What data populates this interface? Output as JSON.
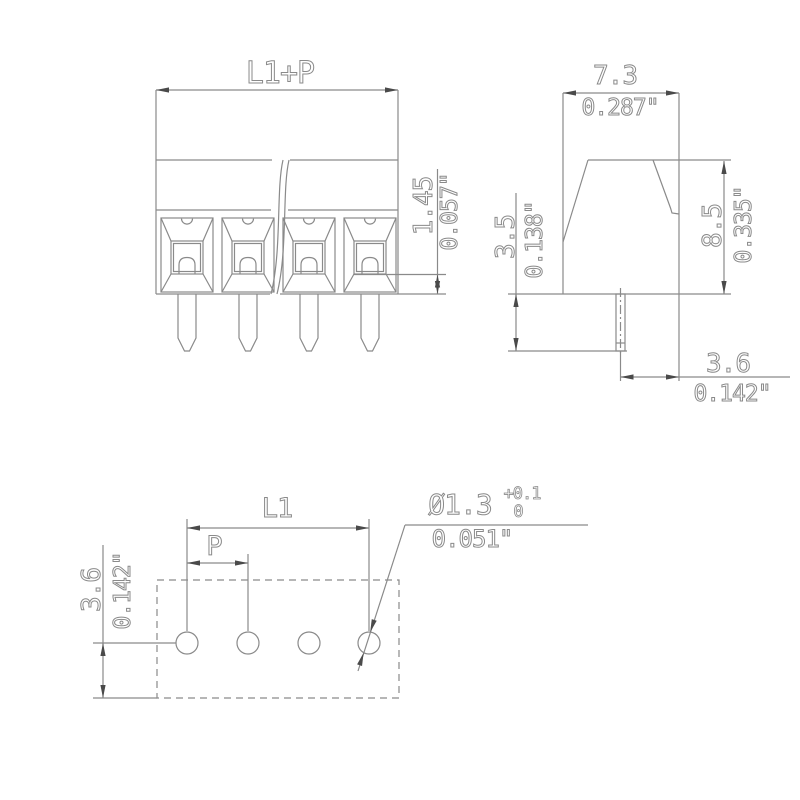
{
  "drawing_type": "terminal-block-dimension-drawing",
  "views": {
    "front": {
      "width_label": "L1+P",
      "depth_mm": "1.45",
      "depth_in": "0.057\"",
      "pole_count_visible": 4
    },
    "side": {
      "width_mm": "7.3",
      "width_in": "0.287\"",
      "pin_len_mm": "3.5",
      "pin_len_in": "0.138\"",
      "height_mm": "8.5",
      "height_in": "0.335\"",
      "pin_offset_mm": "3.6",
      "pin_offset_in": "0.142\""
    },
    "footprint": {
      "row_label": "L1",
      "pitch_label": "P",
      "edge_mm": "3.6",
      "edge_in": "0.142\"",
      "hole_label": "Ø1.3",
      "hole_tol_upper": "+0.1",
      "hole_tol_lower": "0",
      "hole_in": "0.051\"",
      "hole_count": 4
    }
  },
  "colors": {
    "background": "#ffffff",
    "line": "#8a8a8a",
    "arrow": "#4a4a4a"
  }
}
